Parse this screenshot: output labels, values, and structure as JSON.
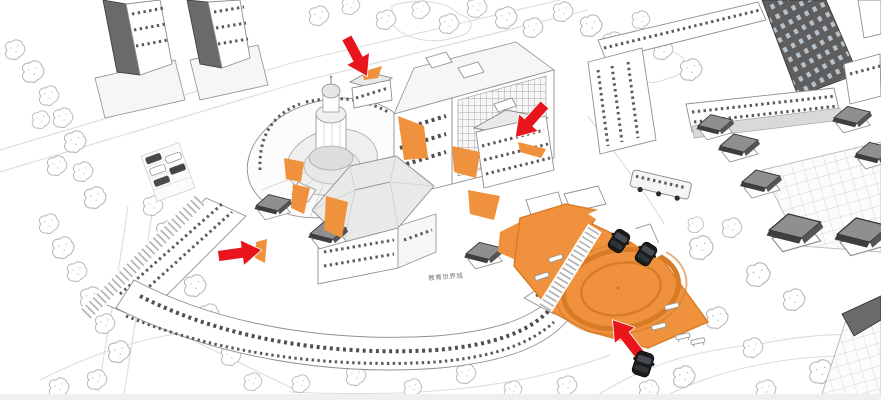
{
  "page": {
    "title": "Campus aerial axonometric site illustration"
  },
  "signage": {
    "building_sign": "教育世界城"
  },
  "annotations": {
    "arrow_count": 4,
    "arrows": [
      {
        "id": "arrow-1",
        "direction": "down-right",
        "x": 357,
        "y": 57
      },
      {
        "id": "arrow-2",
        "direction": "down-left",
        "x": 530,
        "y": 121
      },
      {
        "id": "arrow-3",
        "direction": "right",
        "x": 240,
        "y": 253
      },
      {
        "id": "arrow-4",
        "direction": "up-left",
        "x": 626,
        "y": 337
      }
    ]
  },
  "site": {
    "highlighted_areas": [
      "circular plaza",
      "pedestrian path network",
      "entrance slivers"
    ],
    "vehicles": {
      "black_cars": 3,
      "bus": 1
    },
    "street_furniture": {
      "benches": 6
    }
  },
  "colors": {
    "plaza_orange": "#F0923D",
    "plaza_ring": "#D87B26",
    "arrow_red": "#E8151D",
    "dark_facade": "#5E5E5E",
    "line_gray": "#9A9A9A"
  }
}
